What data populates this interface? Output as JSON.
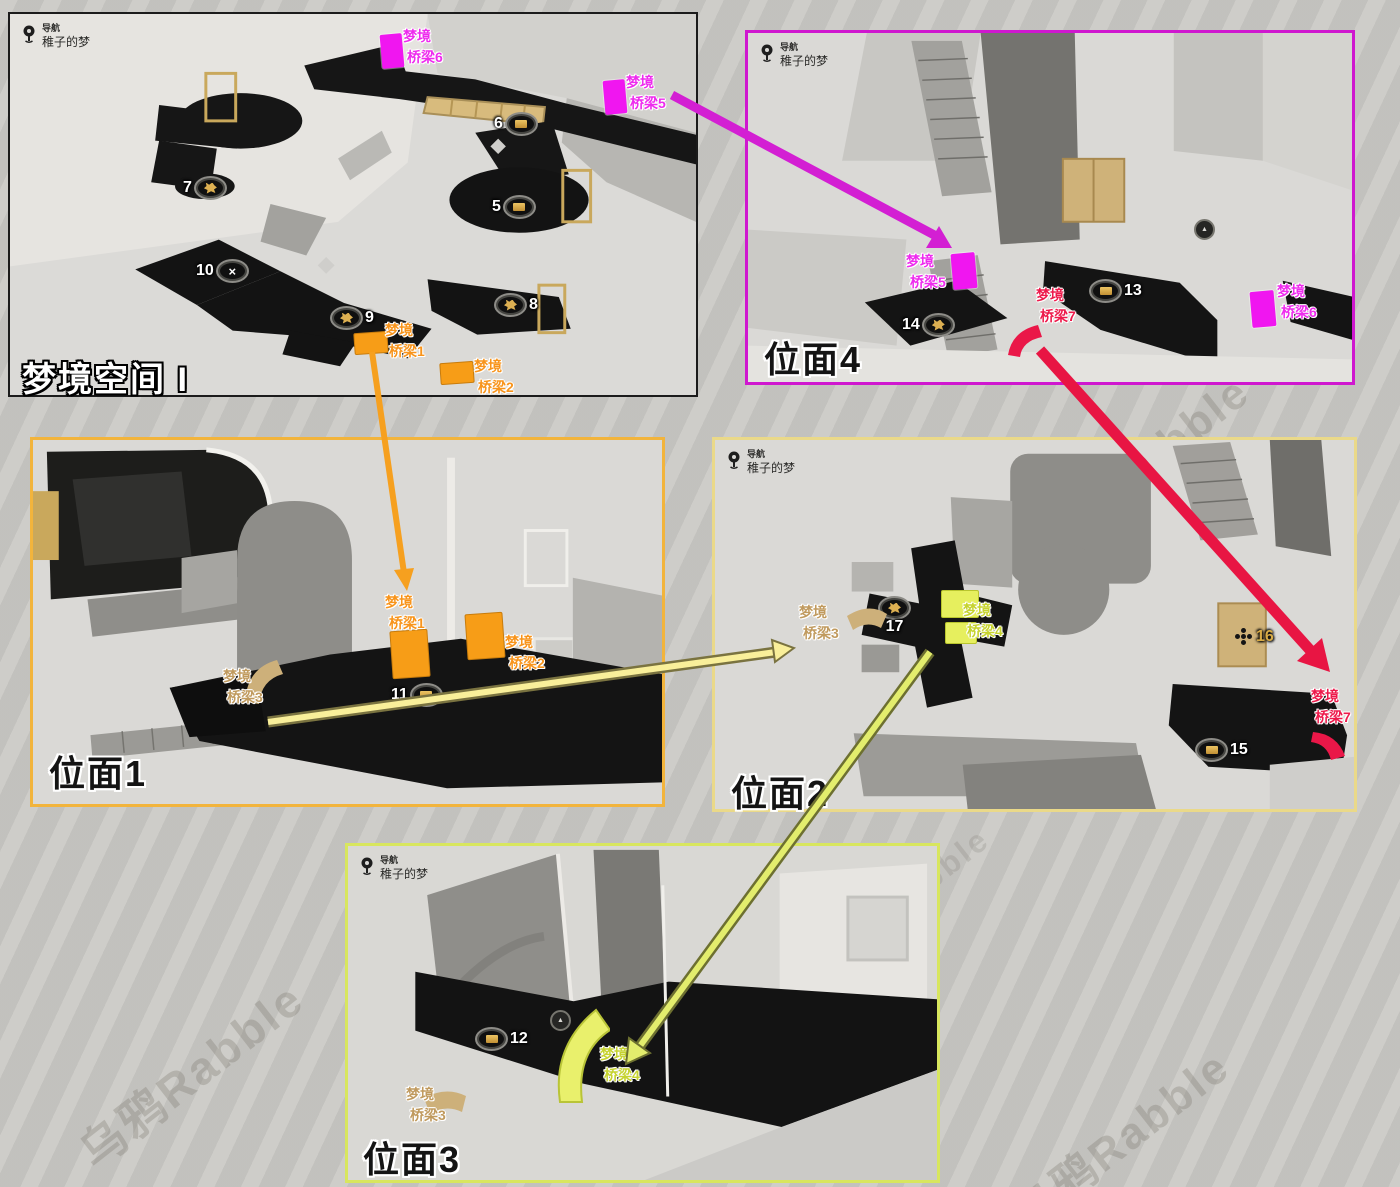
{
  "page": {
    "watermark": "乌鸦Rabble",
    "background": "#c7c6c2"
  },
  "nav": {
    "label": "导航",
    "place": "稚子的梦"
  },
  "panels": {
    "dream_space": {
      "title": "梦境空间 I",
      "border_color": "#1b1b1b"
    },
    "plane4": {
      "title": "位面4",
      "border_color": "#cf17cf"
    },
    "plane1": {
      "title": "位面1",
      "border_color": "#f2b43c"
    },
    "plane2": {
      "title": "位面2",
      "border_color": "#ead989"
    },
    "plane3": {
      "title": "位面3",
      "border_color": "#d8e65e"
    }
  },
  "markers": {
    "m5": "5",
    "m6": "6",
    "m7": "7",
    "m8": "8",
    "m9": "9",
    "m10": "10",
    "m11": "11",
    "m12": "12",
    "m13": "13",
    "m14": "14",
    "m15": "15",
    "m16": "16",
    "m17": "17"
  },
  "bridges": {
    "b1": {
      "line1": "梦境",
      "line2": "桥梁1",
      "color": "#f8941b"
    },
    "b2": {
      "line1": "梦境",
      "line2": "桥梁2",
      "color": "#f8941b"
    },
    "b3": {
      "line1": "梦境",
      "line2": "桥梁3",
      "color": "#c09a5e"
    },
    "b4": {
      "line1": "梦境",
      "line2": "桥梁4",
      "color": "#c6d32f"
    },
    "b5": {
      "line1": "梦境",
      "line2": "桥梁5",
      "color": "#ee2bee"
    },
    "b6": {
      "line1": "梦境",
      "line2": "桥梁6",
      "color": "#ee2bee"
    },
    "b7": {
      "line1": "梦境",
      "line2": "桥梁7",
      "color": "#ed1a4b"
    }
  },
  "icons": {
    "x": "×",
    "teleport": "▲"
  },
  "arrow_colors": {
    "magenta": "#d31fd3",
    "orange": "#f6a01f",
    "pale_yellow": "#f9ef9a",
    "red": "#e81543",
    "yellow_green": "#e3ed6d"
  }
}
